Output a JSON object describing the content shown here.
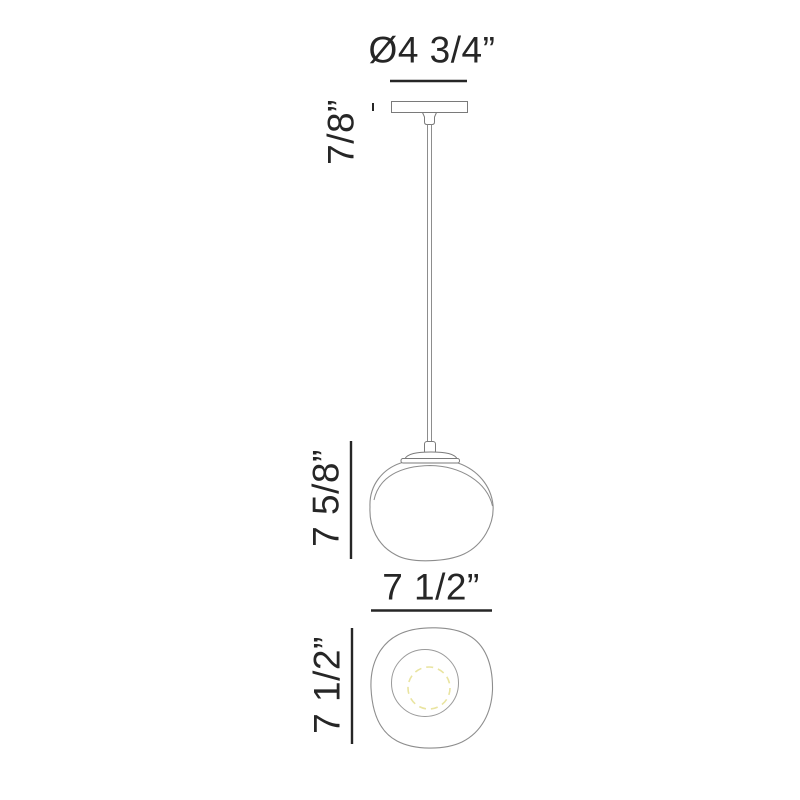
{
  "drawing": {
    "title": "pendant-light-dimension-drawing",
    "labels": {
      "canopy_diameter": "Ø4 3/4”",
      "canopy_height": "7/8”",
      "globe_height": "7 5/8”",
      "globe_width": "7 1/2”",
      "bottom_view_diameter": "7 1/2”"
    },
    "colors": {
      "background": "#ffffff",
      "ink": "#262626",
      "outline": "#8d8d8d",
      "fitting_line": "#7a7a7a",
      "bulb_dashed": "#e9e4a0"
    },
    "views": {
      "side_view": "pendant with canopy, cord and organic globe shade",
      "bottom_view": "concentric rings with dashed bulb circle"
    }
  }
}
